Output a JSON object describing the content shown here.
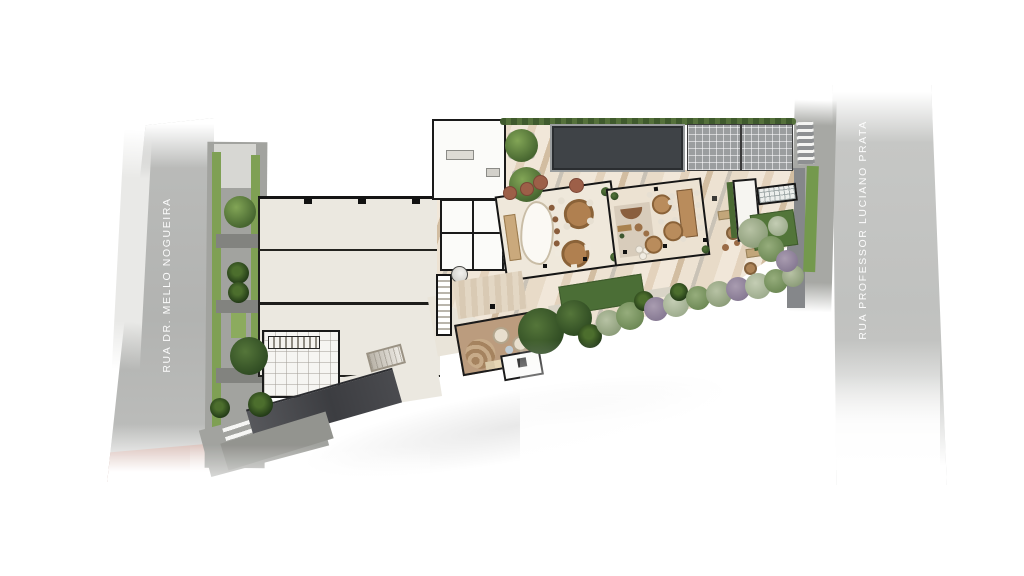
{
  "scene": {
    "type": "architectural ground-floor site plan rendering",
    "background_color": "#ffffff"
  },
  "streets": {
    "left": {
      "name": "RUA DR. MELLO NOGUEIRA",
      "label_color": "#ffffff",
      "surface_color": "#b6b7b5",
      "accent_band_color": "#c97b69"
    },
    "right": {
      "name": "RUA PROFESSOR LUCIANO PRATA",
      "label_color": "#ffffff",
      "surface_color": "#c4c5c3"
    }
  },
  "site": {
    "colors": {
      "floor_plate": "#ebe8e0",
      "walls": "#1a1a1a",
      "terrace_stripe_light": "#f1e7d9",
      "terrace_stripe_tan": "#e3d2bc",
      "terrace_stripe_brown": "#d2bda1",
      "terrace_stripe_gray": "#c9c2b6",
      "dark_roof": "#3f4347",
      "glass_roof": "#9b9e9f",
      "hedge": "#44602e",
      "lawn": "#4b6e36",
      "wood_floor": "#bb9c7e",
      "ramp": "#47484c",
      "sidewalk": "#a2a39f",
      "planting_strip": "#7fa054"
    }
  }
}
